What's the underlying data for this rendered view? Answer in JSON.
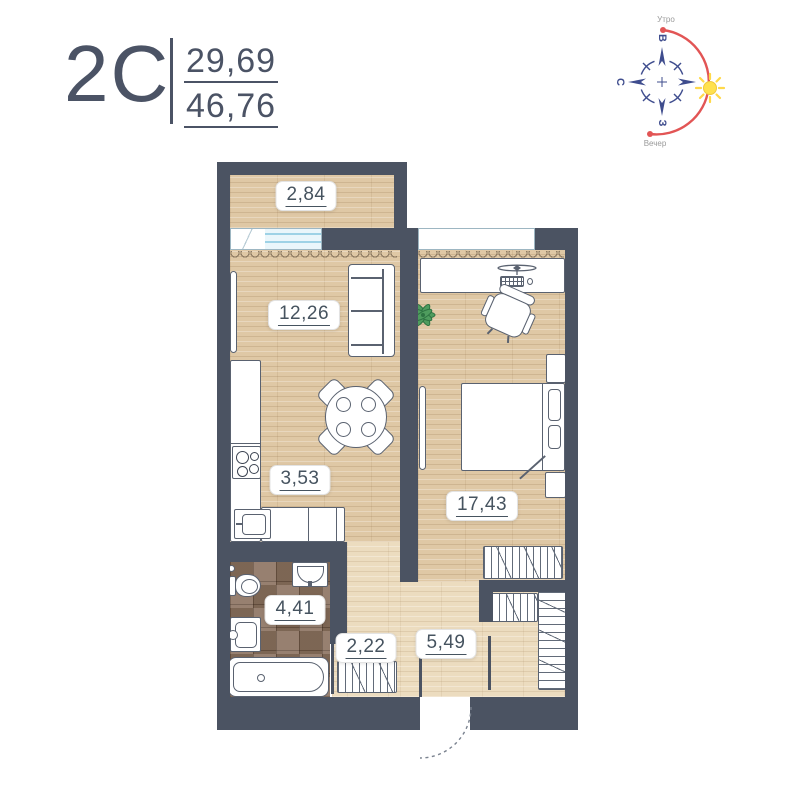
{
  "header": {
    "plan_code": "2C",
    "area_top": "29,69",
    "area_bottom": "46,76"
  },
  "compass": {
    "morning_label": "Утро",
    "evening_label": "Вечер",
    "dir_top": "В",
    "dir_left": "С",
    "dir_bottom": "З",
    "arrow_color": "#3f4d8e",
    "arc_color": "#e25555",
    "sun_color": "#ffe14d"
  },
  "plan": {
    "wall_color": "#4b5362",
    "floor_wood_color": "#dfc8a5",
    "floor_corridor_color": "#ecdcbf",
    "floor_tile_color": "#8b7260",
    "window_glass_color": "#9ed2e6",
    "rooms": {
      "balcony": {
        "area": "2,84"
      },
      "living": {
        "area": "12,26"
      },
      "kitchen": {
        "area": "3,53"
      },
      "bedroom": {
        "area": "17,43"
      },
      "bathroom": {
        "area": "4,41"
      },
      "hallway": {
        "area": "2,22"
      },
      "corridor": {
        "area": "5,49"
      }
    }
  }
}
